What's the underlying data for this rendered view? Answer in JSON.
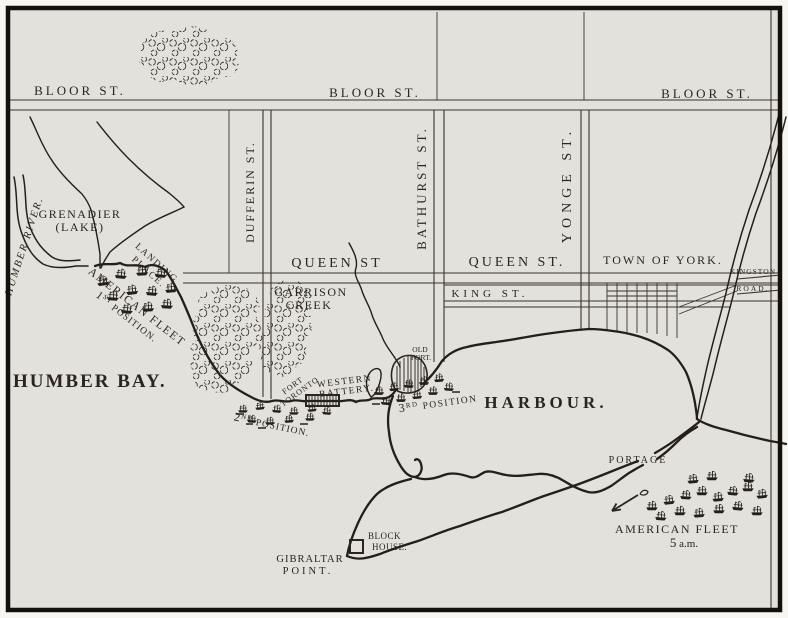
{
  "palette": {
    "paper": "#e3e1db",
    "ink": "#2b251e",
    "page_bg": "#f7f6f2"
  },
  "streets": {
    "bloor_w": "BLOOR ST.",
    "bloor_m": "BLOOR ST.",
    "bloor_e": "BLOOR ST.",
    "dufferin": "DUFFERIN ST.",
    "bathurst": "BATHURST ST.",
    "yonge": "YONGE ST.",
    "queen_w": "QUEEN ST",
    "queen_e": "QUEEN ST.",
    "king": "KING ST.",
    "kingston": "KINGSTON",
    "road": "ROAD."
  },
  "water": {
    "humber_river": "HUMBER RIVER.",
    "grenadier": "GRENADIER",
    "lake": "(LAKE)",
    "humber_bay": "HUMBER BAY.",
    "garrison": "GARRISON",
    "creek": "CREEK",
    "harbour": "HARBOUR."
  },
  "places": {
    "town_of_york": "TOWN OF YORK.",
    "old": "OLD",
    "old_fort": "FORT.",
    "fort": "FORT",
    "fort_toronto": "TORONTO",
    "western": "WESTERN",
    "battery": "BATTERY.",
    "block": "BLOCK",
    "house": "HOUSE.",
    "gibraltar": "GIBRALTAR",
    "point": "POINT.",
    "portage": "PORTAGE"
  },
  "military": {
    "landing": "LANDING",
    "place": "PLACE.",
    "fleet1": "AMERICAN FLEET",
    "pos1_n": "1",
    "pos1_s": "ST",
    "pos1_r": " POSITION.",
    "pos2_n": "2",
    "pos2_s": "ND",
    "pos2_r": " POSITION.",
    "pos3_n": "3",
    "pos3_s": "RD",
    "pos3_r": " POSITION",
    "fleet5": "AMERICAN FLEET",
    "time_n": "5",
    "time_r": " a.m."
  }
}
